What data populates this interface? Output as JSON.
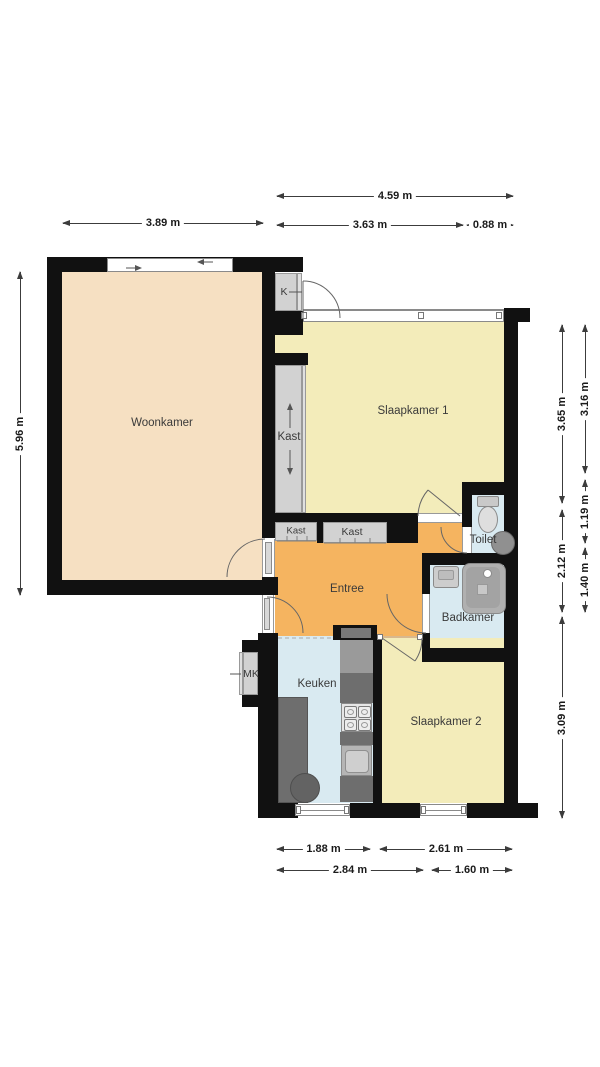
{
  "colors": {
    "wall": "#111111",
    "floor_woonkamer": "#f6e0c2",
    "floor_bedroom": "#f3ecba",
    "floor_entree": "#f5b460",
    "floor_wet": "#d9eaf1",
    "closet_fill": "#d2d2d2",
    "closet_border": "#9a9a9a",
    "counter": "#6e6e6e",
    "dim": "#3c3c3c"
  },
  "rooms": {
    "woonkamer": {
      "label": "Woonkamer"
    },
    "slaapkamer1": {
      "label": "Slaapkamer 1"
    },
    "slaapkamer2": {
      "label": "Slaapkamer 2"
    },
    "entree": {
      "label": "Entree"
    },
    "keuken": {
      "label": "Keuken"
    },
    "toilet": {
      "label": "Toilet"
    },
    "badkamer": {
      "label": "Badkamer"
    }
  },
  "closets": {
    "kast_tall": {
      "label": "Kast"
    },
    "kast_left": {
      "label": "Kast"
    },
    "kast_mid": {
      "label": "Kast"
    },
    "k": {
      "label": "K"
    },
    "mk": {
      "label": "MK"
    }
  },
  "dimensions": {
    "top_total": "4.59 m",
    "top_left": "3.63 m",
    "top_right": "0.88 m",
    "left_width": "3.89 m",
    "left_height": "5.96 m",
    "right_inner_top": "3.65 m",
    "right_inner_mid": "2.12 m",
    "right_inner_bottom": "3.09 m",
    "right_outer_top": "3.16 m",
    "right_outer_mid": "1.19 m",
    "right_outer_bottom": "1.40 m",
    "bottom_row1_left": "1.88 m",
    "bottom_row1_right": "2.61 m",
    "bottom_row2_left": "2.84 m",
    "bottom_row2_right": "1.60 m"
  }
}
